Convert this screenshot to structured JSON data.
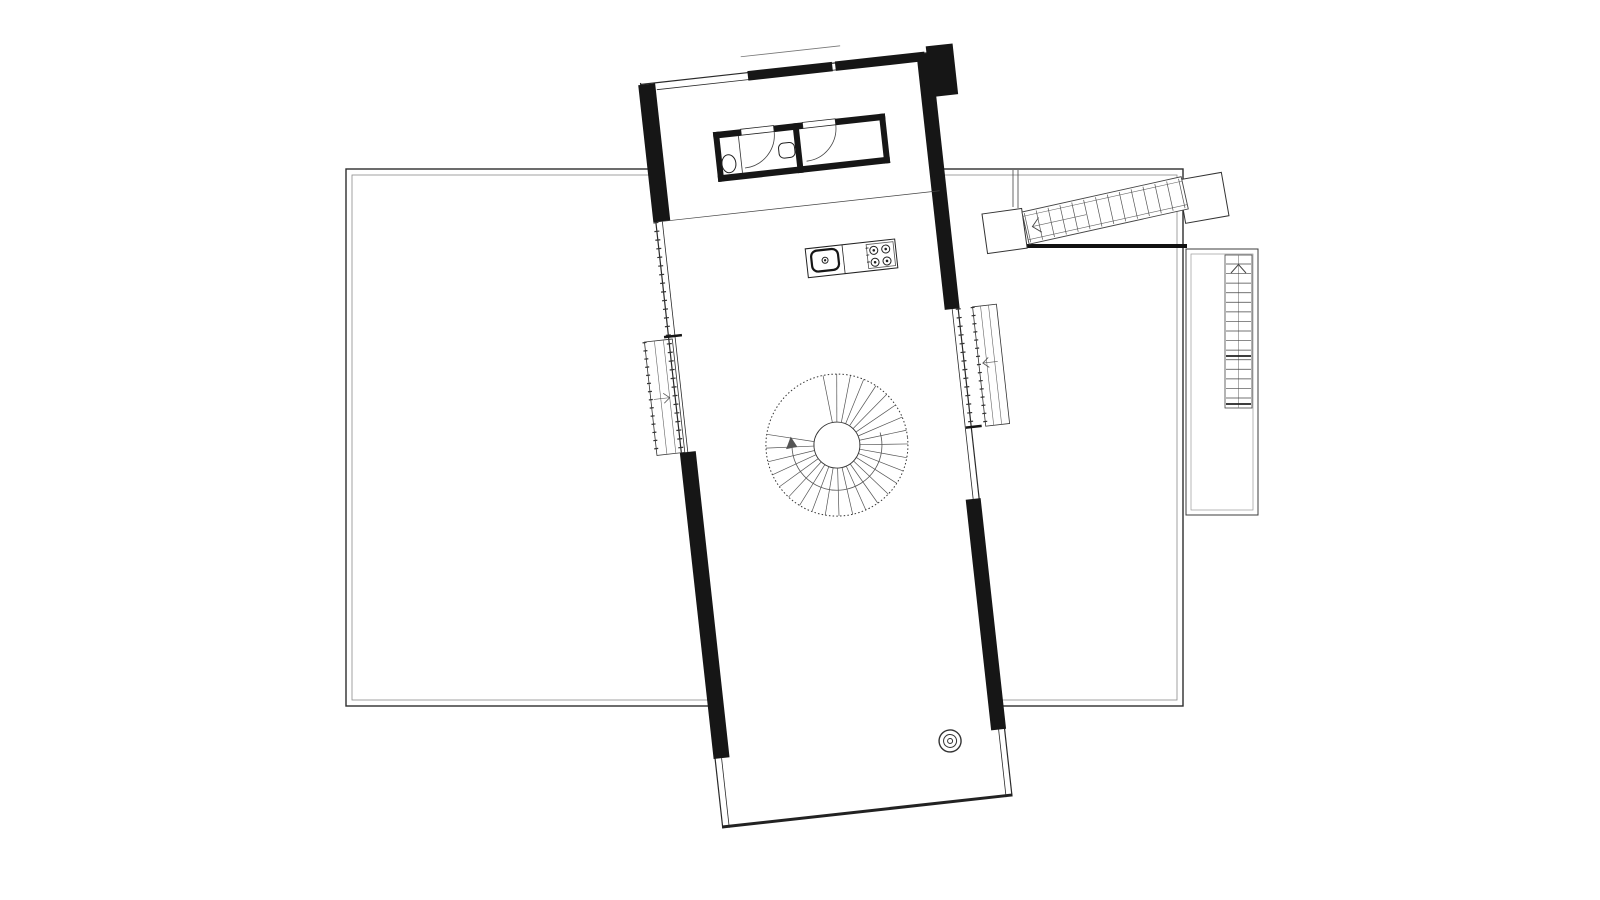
{
  "document": {
    "type": "architectural-floor-plan",
    "background": "#ffffff"
  },
  "colors": {
    "wall_black": "#161616",
    "outline_dark": "#2e2e2e",
    "line_medium": "#444444",
    "line_light": "#8a8a8a",
    "fixture": "#222222"
  },
  "site": {
    "outer_rect": {
      "x": 346,
      "y": 169,
      "w": 837,
      "h": 537
    },
    "inner_offset": 6,
    "retaining_edge": {
      "x1": 1018,
      "y": 246,
      "x2": 1187,
      "thickness": 4
    },
    "wall_stub": {
      "x1": 1013,
      "x2": 1018,
      "y1": 170,
      "y2": 207
    }
  },
  "building": {
    "origin_x": 640,
    "origin_y": 83,
    "rotation_deg": -6.3,
    "width": 292,
    "height": 750,
    "mezzanine_line_y": 140,
    "canopy_line": {
      "x1": 103,
      "x2": 203,
      "y": -15
    }
  },
  "bathroom": {
    "x": 67,
    "y": 57,
    "w": 173,
    "h": 50,
    "stalls": 2,
    "fixtures": [
      "toilet",
      "washbasin",
      "swing-door-left",
      "swing-door-right"
    ]
  },
  "kitchen": {
    "counter": {
      "x": 146,
      "y": 183,
      "w": 90,
      "h": 29
    },
    "fixtures": [
      "sink",
      "cooktop-4-burner"
    ]
  },
  "spiral_stair": {
    "cx": 156,
    "cy": 381.5,
    "outer_radius": 71,
    "inner_radius": 23,
    "treads": 27,
    "start_deg": 265,
    "end_deg": 555,
    "arrow_radius": 45,
    "arrow_start_deg": -10,
    "arrow_end_deg": 185
  },
  "fireplace": {
    "cx": 236,
    "cy": 688,
    "radii": [
      11,
      6.5,
      2.5
    ]
  },
  "window_left": {
    "x": -24,
    "y": 258,
    "w": 28,
    "h": 114,
    "arrow_dir": "right"
  },
  "window_right": {
    "x": 306,
    "y": 259,
    "w": 24,
    "h": 120,
    "arrow_dir": "left"
  },
  "bridge_stair": {
    "x": 1022,
    "y": 212,
    "angle_deg": -12.5,
    "length": 163,
    "width": 33,
    "treads": 14,
    "stringer_inset": 4.5,
    "landing_left": {
      "x": 982,
      "y": 214,
      "size": 40,
      "angle_deg": -8
    },
    "landing_right": {
      "x": 1178,
      "y": 180,
      "size": 44,
      "angle_deg": -10
    }
  },
  "terrace_right": {
    "outer": {
      "x": 1186,
      "y": 249,
      "w": 72,
      "h": 266
    },
    "inner": {
      "x": 1191,
      "y": 254,
      "w": 62,
      "h": 256
    }
  },
  "ladder_stair": {
    "x": 1225,
    "y": 255,
    "w": 27,
    "h": 153,
    "rungs": 15,
    "bold_rungs_y": [
      356,
      404
    ]
  }
}
